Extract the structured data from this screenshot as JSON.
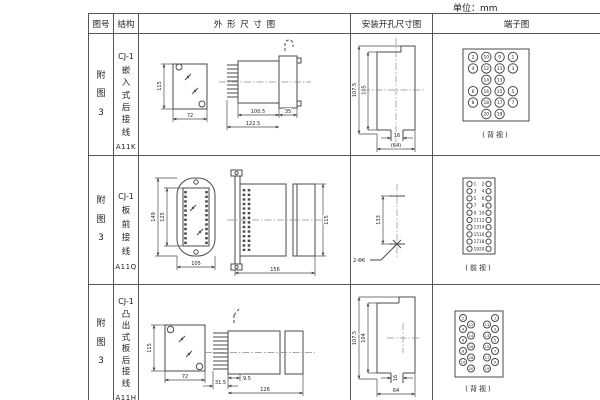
{
  "unit_label": "单位：mm",
  "table": {
    "headers": [
      "图号",
      "结构",
      "外形尺寸图",
      "安装开孔尺寸图",
      "端子图"
    ],
    "rows": [
      {
        "fig_no": "附图3",
        "model": "CJ-1",
        "structure": "嵌入式后接线",
        "code": "A11K",
        "outline": {
          "front_height": "115",
          "front_width": "72",
          "body_length": "100.5",
          "total_length": "122.5",
          "flange_depth": "35"
        },
        "install": {
          "outer_height": "107.5",
          "inner_height": "105",
          "slot_width": "16",
          "opening_width": "(64)"
        },
        "terminal": {
          "view_label": "(背视)",
          "grid": [
            [
              2,
              10,
              9,
              1
            ],
            [
              4,
              12,
              11,
              3
            ],
            [
              null,
              14,
              13,
              null
            ],
            [
              6,
              16,
              15,
              5
            ],
            [
              8,
              18,
              17,
              7
            ],
            [
              null,
              20,
              19,
              null
            ]
          ]
        }
      },
      {
        "fig_no": "附图3",
        "model": "CJ-1",
        "structure": "板前接线",
        "code": "A11Q",
        "outline": {
          "outer_height": "149",
          "inner_height": "125",
          "front_width": "105",
          "total_length": "156",
          "side_height": "115"
        },
        "install": {
          "hole_spacing": "133",
          "hole_label": "2-Φ6"
        },
        "terminal": {
          "view_label": "(前视)",
          "left": [
            1,
            3,
            5,
            7,
            9,
            11,
            13,
            15,
            17,
            19
          ],
          "right": [
            2,
            4,
            6,
            8,
            10,
            12,
            14,
            16,
            18,
            20
          ]
        }
      },
      {
        "fig_no": "附图3",
        "model": "CJ-1",
        "structure": "凸出式板后接线",
        "code": "A11H",
        "outline": {
          "front_height": "115",
          "front_width": "72",
          "pin_length": "31.5",
          "offset": "9.5",
          "body_length": "126"
        },
        "install": {
          "outer_height": "107.5",
          "inner_height": "104",
          "slot_width": "16",
          "opening_width": "64"
        },
        "terminal": {
          "view_label": "(背视)",
          "left_outer": [
            2,
            4,
            6,
            8,
            10
          ],
          "left_inner": [
            12,
            14,
            16,
            18,
            20
          ],
          "right_inner": [
            11,
            13,
            15,
            17,
            19
          ],
          "right_outer": [
            1,
            3,
            5,
            7,
            9
          ]
        }
      }
    ]
  }
}
